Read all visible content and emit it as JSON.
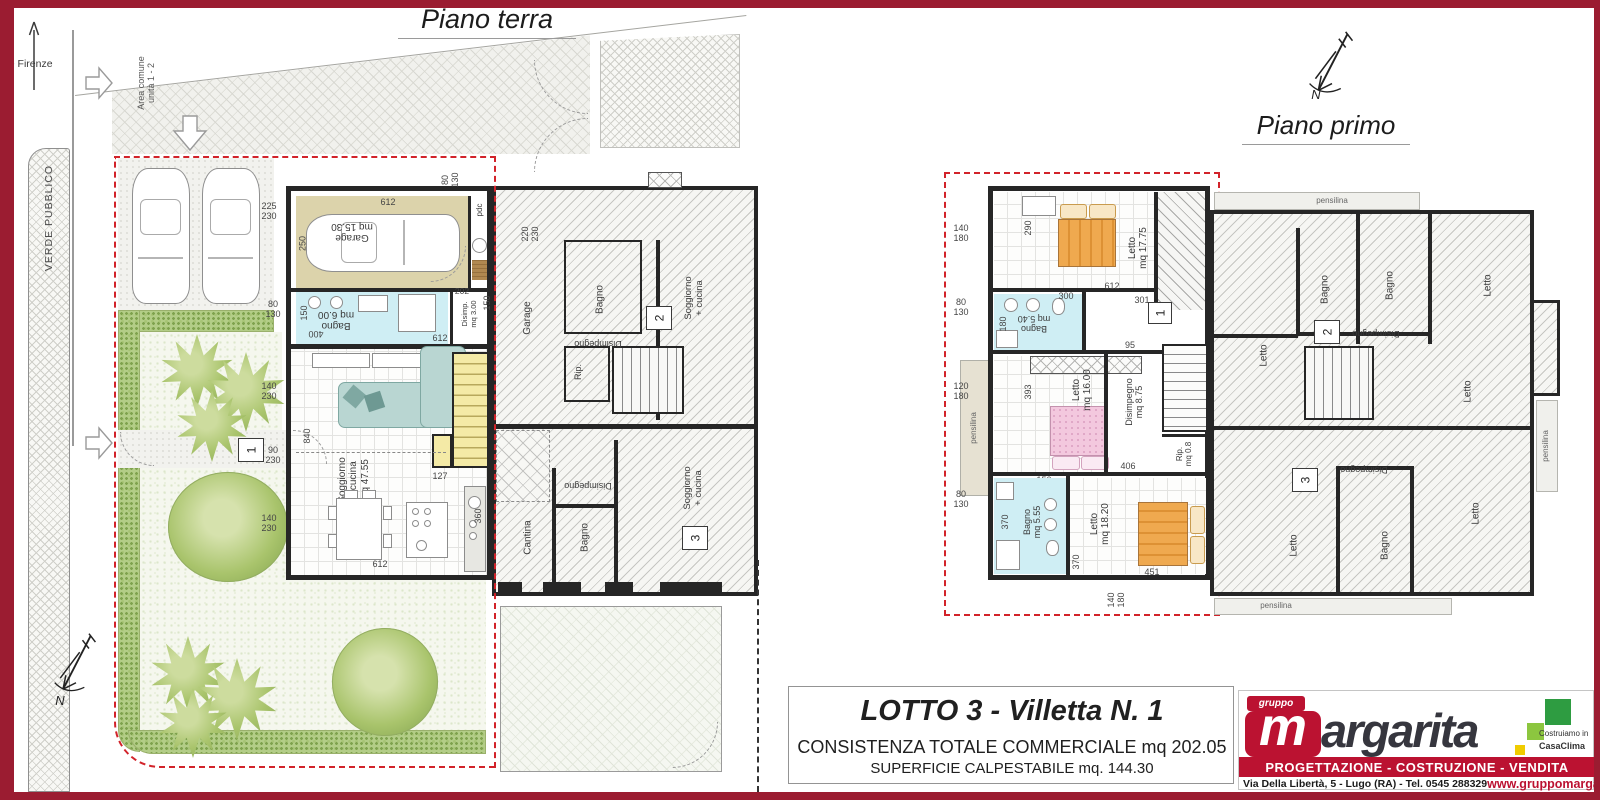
{
  "colors": {
    "frame": "#9b1c31",
    "brand_red": "#bb1231",
    "boundary_red": "#d2232a",
    "casaclima_green": "#2e9c41"
  },
  "titles": {
    "ground": "Piano terra",
    "first": "Piano primo",
    "north": "N"
  },
  "site": {
    "street": "Viale Firenze",
    "green_strip": "VERDE PUBBLICO",
    "common_area": "Area comune\nunità 1 - 2"
  },
  "gf": {
    "unit_badge": "1",
    "rooms": {
      "garage": "Garage\nmq 15.30",
      "bagno": "Bagno\nmq 6.00",
      "disimp": "Disimp.\nmq 3.00",
      "soggiorno": "Soggiorno\n+ cucina\nmq 47.55",
      "pdc": "pdc"
    },
    "dims": {
      "garage_top": "612",
      "left_a": "225\n230",
      "garage_h": "250",
      "top_v": "80\n130",
      "left_b": "80\n130",
      "bagno_w": "400",
      "bagno_h": "150",
      "disimp_a": "202",
      "disimp_b": "150",
      "mid": "612",
      "left_c": "140\n230",
      "left_d": "90\n230",
      "sogg_h": "840",
      "left_e": "140\n230",
      "stair": "127",
      "kitchen": "360",
      "bottom": "612",
      "neighbor": "220\n230"
    },
    "neighbor": {
      "garage": "Garage",
      "bagno_top": "Bagno",
      "disimpegno_top": "Disimpegno",
      "rip": "Rip.",
      "soggiorno_top": "Soggiorno\n+ cucina",
      "unit2": "2",
      "cantina": "Cantina",
      "bagno_bottom": "Bagno",
      "disimpegno_bottom": "Disimpegno",
      "soggiorno_bottom": "Soggiorno\n+ cucina",
      "unit3": "3"
    }
  },
  "ff": {
    "unit_badge": "1",
    "pensilina_left": "pensilina",
    "rooms": {
      "letto1": "Letto\nmq 17.75",
      "bagno1": "Bagno\nmq 5.40",
      "letto2": "Letto\nmq 16.00",
      "disimpegno": "Disimpegno\nmq 8.75",
      "rip": "Rip.\nmq 0.8",
      "bagno2": "Bagno\nmq 5.55",
      "letto3": "Letto\nmq 18.20"
    },
    "dims": {
      "left_a": "140\n180",
      "left_b": "80\n130",
      "left_c": "120\n180",
      "left_d": "80\n130",
      "letto1_h": "290",
      "mid": "612",
      "bagno1_w": "300",
      "hall": "301",
      "bagno1_h": "180",
      "hall_b": "95",
      "letto2_h": "393",
      "disimp_b": "406",
      "bagno2_t": "150",
      "bagno2_h": "370",
      "letto3_h": "370",
      "letto3_w": "451",
      "bottom": "140\n180"
    },
    "neighbor": {
      "pensilina_top": "pensilina",
      "pensilina_bottom": "pensilina",
      "pensilina_right": "pensilina",
      "bagno_a": "Bagno",
      "bagno_b": "Bagno",
      "bagno_c": "Bagno",
      "letto_a": "Letto",
      "letto_b": "Letto",
      "letto_c": "Letto",
      "letto_d": "Letto",
      "letto_e": "Letto",
      "disimpegno_a": "Disimpegno",
      "disimpegno_b": "Disimpegno",
      "unit2": "2",
      "unit3": "3"
    }
  },
  "title_block": {
    "title": "LOTTO 3 - Villetta  N. 1",
    "line1": "CONSISTENZA TOTALE COMMERCIALE mq  202.05",
    "line2": "SUPERFICIE CALPESTABILE  mq. 144.30"
  },
  "logo": {
    "gruppo": "gruppo",
    "m": "m",
    "brand": "argarita",
    "casaclima1": "Costruiamo in",
    "casaclima2": "CasaClima",
    "bar": "PROGETTAZIONE  -  COSTRUZIONE  -  VENDITA",
    "address": "Via Della Libertà, 5 - Lugo (RA) - Tel. 0545 288329",
    "website": "www.gruppomargarita.it"
  }
}
